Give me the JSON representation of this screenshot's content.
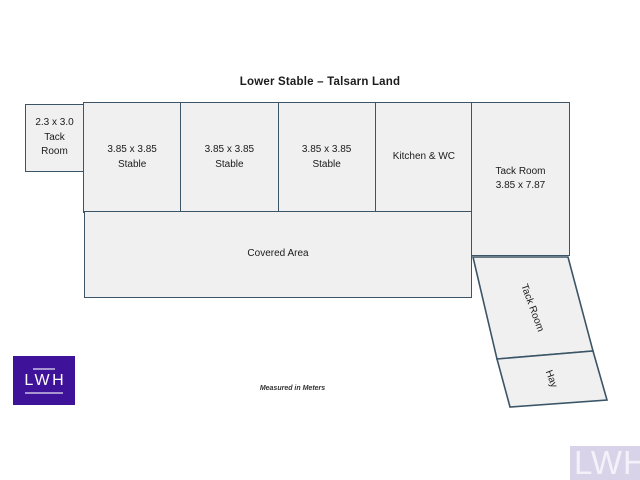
{
  "title": "Lower Stable – Talsarn Land",
  "footnote": "Measured in Meters",
  "rooms": {
    "small_tack": {
      "dim": "2.3 x 3.0",
      "name_line1": "Tack",
      "name_line2": "Room"
    },
    "stables": [
      {
        "dim": "3.85 x 3.85",
        "label": "Stable"
      },
      {
        "dim": "3.85 x 3.85",
        "label": "Stable"
      },
      {
        "dim": "3.85 x 3.85",
        "label": "Stable"
      }
    ],
    "kitchen": {
      "label": "Kitchen & WC"
    },
    "tack_room_right": {
      "name": "Tack Room",
      "dim": "3.85 x 7.87"
    },
    "covered_area": {
      "label": "Covered Area"
    },
    "tack_room_lower": {
      "label": "Tack Room"
    },
    "hay": {
      "label": "Hay"
    }
  },
  "logo": {
    "text": "LWH"
  },
  "watermark": {
    "text": "LWH"
  },
  "colors": {
    "border": "#3b5566",
    "room_fill": "#f0f0f1",
    "text": "#1b1b1b",
    "logo_bg": "#3e1399",
    "logo_text": "#ffffff",
    "watermark_bg": "#d9d3e9",
    "watermark_text": "#f4f1f9"
  }
}
